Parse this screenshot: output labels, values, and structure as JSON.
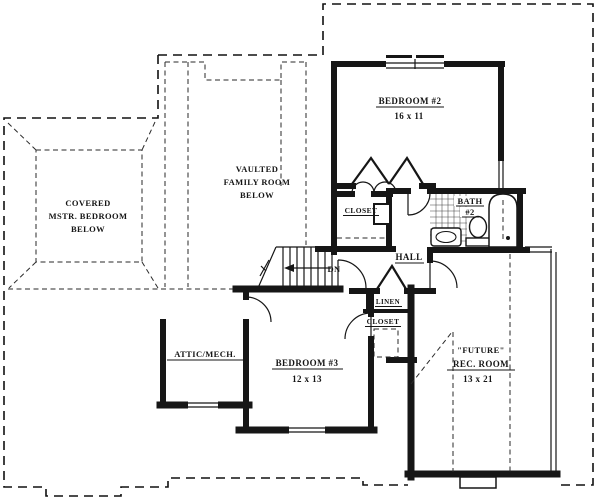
{
  "plan": {
    "rooms": {
      "master_bedroom": {
        "line1": "COVERED",
        "line2": "MSTR. BEDROOM",
        "line3": "BELOW"
      },
      "family_room": {
        "line1": "VAULTED",
        "line2": "FAMILY ROOM",
        "line3": "BELOW"
      },
      "bedroom_2": {
        "name": "BEDROOM #2",
        "dims": "16 x 11"
      },
      "bedroom_2_closet": {
        "name": "CLOSET"
      },
      "bath_2": {
        "name": "BATH",
        "number": "#2"
      },
      "hall": {
        "name": "HALL"
      },
      "stairs": {
        "label": "DN"
      },
      "linen": {
        "name": "LINEN"
      },
      "bedroom_3_closet": {
        "name": "CLOSET"
      },
      "bedroom_3": {
        "name": "BEDROOM #3",
        "dims": "12 x 13"
      },
      "attic_mech": {
        "name": "ATTIC/MECH."
      },
      "rec_room": {
        "qualifier": "\"FUTURE\"",
        "name": "REC. ROOM",
        "dims": "13 x 21"
      }
    },
    "colors": {
      "ink": "#161616",
      "background": "#ffffff"
    }
  }
}
